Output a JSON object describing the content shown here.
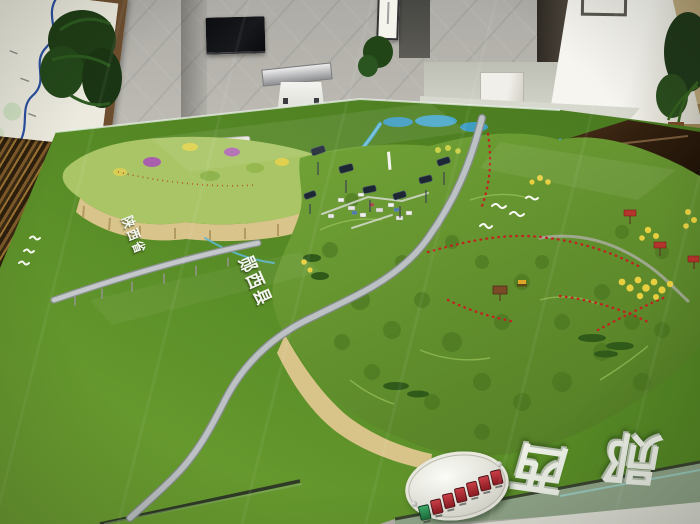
{
  "scene": {
    "type": "photograph",
    "setting": "exhibition hall with a large physical 3D terrain model (sand table) of Yunxi county displayed under glass"
  },
  "model": {
    "region_labels": [
      "陕西省",
      "郧西县"
    ],
    "front_calligraphy": [
      "西",
      "郧"
    ],
    "control_panel": {
      "shape": "white oval plate",
      "buttons": [
        "green",
        "red",
        "red",
        "red",
        "red",
        "red",
        "red"
      ]
    },
    "features": [
      "green turf base",
      "tan contour cliffs",
      "gray winding roads and viaduct",
      "blue rivers and ponds",
      "red dotted trail markers",
      "yellow tree clusters",
      "white town buildings",
      "navy viewer scopes on poles",
      "white bird figurines",
      "bronze display box",
      "red signposts"
    ]
  },
  "room": {
    "objects": [
      "framed river map",
      "potted palm plants",
      "wall mounted tv",
      "touchscreen podium",
      "hanging scroll",
      "white column with framed picture",
      "carved wooden lattice panel",
      "tan side wall"
    ]
  },
  "colors": {
    "turf": "#5c8f27",
    "terrain": "#679a2f",
    "terrain-dark": "#456f1d",
    "cliff-tan": "#d8c389",
    "water": "#49a8c9",
    "road": "#b7bcbe",
    "trail-red": "#c42020",
    "tree-yellow": "#e8cf3f",
    "bronze": "#3a2414",
    "panel-green": "#1f7a44",
    "panel-red": "#a01d24",
    "glass-cyan": "#9fd8d2",
    "wall-gray": "#b5b2ab",
    "wood-brown": "#6d4e2f"
  }
}
